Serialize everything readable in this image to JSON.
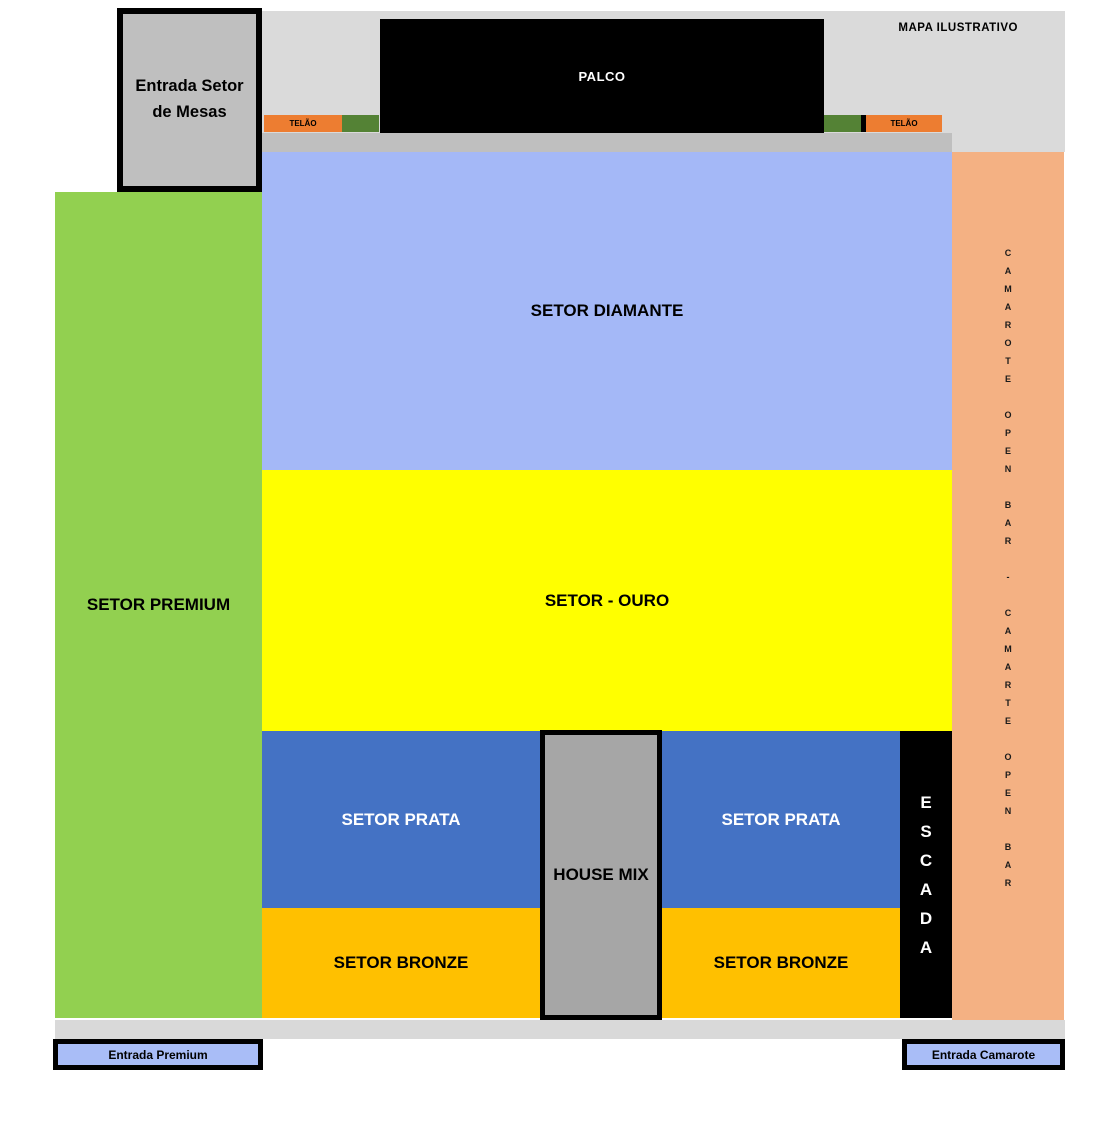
{
  "map_note": "MAPA ILUSTRATIVO",
  "stage_label": "PALCO",
  "screen_label": "TELÃO",
  "sectors": {
    "premium": "SETOR PREMIUM",
    "diamante": "SETOR DIAMANTE",
    "ouro": "SETOR - OURO",
    "prata": "SETOR PRATA",
    "bronze": "SETOR BRONZE"
  },
  "house_mix_label": "HOUSE MIX",
  "escada_words": [
    "ESCADA"
  ],
  "camarote_words": [
    "CAMAROTE",
    "OPEN",
    "BAR",
    "-",
    "CAMARTE",
    "OPEN",
    "BAR"
  ],
  "entrances": {
    "mesas": "Entrada Setor de Mesas",
    "premium": "Entrada Premium",
    "camarote": "Entrada Camarote"
  },
  "colors": {
    "premium": "#92d050",
    "diamante": "#a4b8f7",
    "ouro": "#ffff00",
    "prata": "#4472c4",
    "bronze": "#ffc000",
    "camarote_column": "#f4b183",
    "telao_orange": "#ed7d31",
    "telao_green": "#548235",
    "stage": "#000000",
    "house_mix": "#a6a6a6",
    "entrance_box_blue": "#a9bdf7",
    "mesas_box_gray": "#bfbfbf",
    "top_area_gray": "#dadada",
    "stage_band_gray": "#bfbfbf",
    "bottom_strip_gray": "#d9d9d9"
  }
}
